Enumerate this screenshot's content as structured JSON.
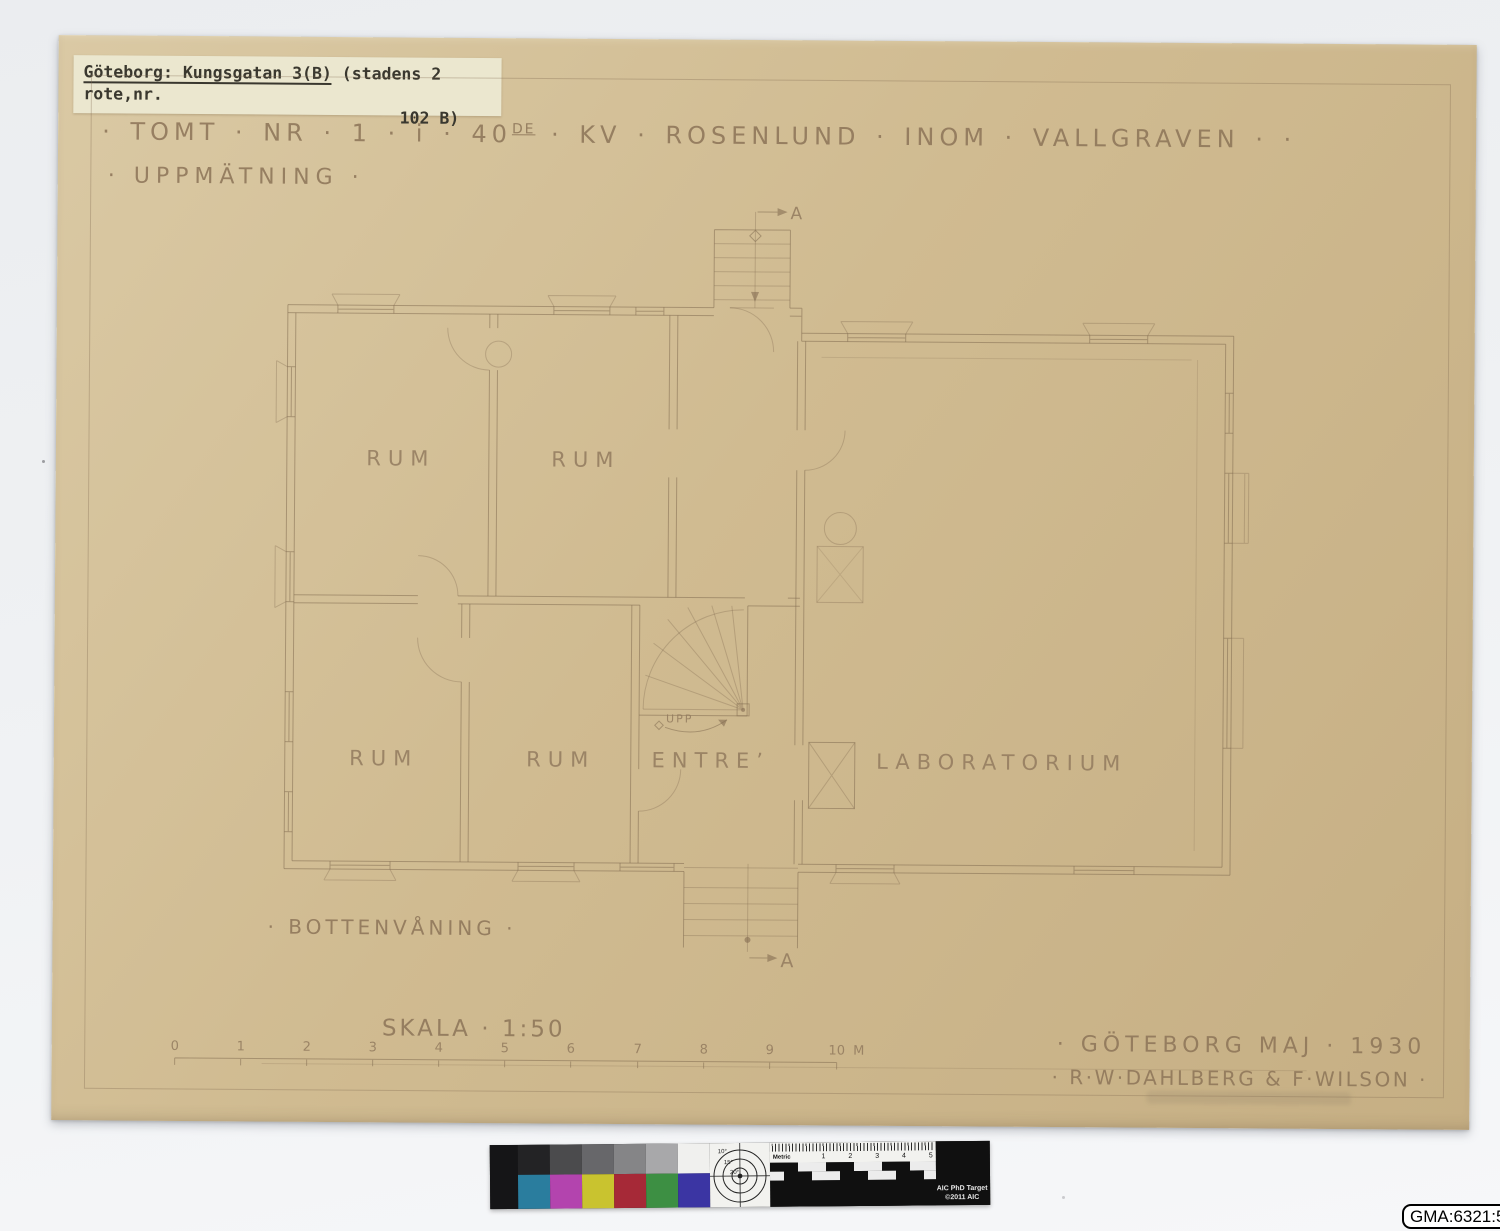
{
  "archive_label": {
    "underlined": "Göteborg: Kungsgatan 3(B)",
    "rest": " (stadens 2 rote,nr.",
    "line2": "102 B)"
  },
  "title": {
    "pre": "· TOMT · NR · 1 · i · 40",
    "sup": "DE",
    "post": " · KV · ROSENLUND · INOM · VALLGRAVEN · ·"
  },
  "subtitle": "· UPPMÄTNING ·",
  "plan": {
    "room_labels": {
      "rum1": "RUM",
      "rum2": "RUM",
      "rum3": "RUM",
      "rum4": "RUM",
      "entre": "ENTRE’",
      "laboratorium": "LABORATORIUM"
    },
    "stair_label": "UPP",
    "section_marker": "A",
    "floor_label": "· BOTTENVÅNING ·"
  },
  "scale": {
    "label": "SKALA · 1:50",
    "ticks": [
      "0",
      "1",
      "2",
      "3",
      "4",
      "5",
      "6",
      "7",
      "8",
      "9",
      "10"
    ],
    "unit": "M"
  },
  "signature": {
    "line1": "· GÖTEBORG  MAJ · 1930",
    "line2": "· R·W·DAHLBERG & F·WILSON ·"
  },
  "catalog_label": "GMA:6321:5",
  "color_target": {
    "gray_patches": [
      "#232325",
      "#4b4b4d",
      "#67676a",
      "#858587",
      "#a8a8aa",
      "#f0f0ee"
    ],
    "color_patches": [
      "#2a7d9e",
      "#b344ae",
      "#c9c32f",
      "#a62937",
      "#3d8f43",
      "#3b35a3"
    ],
    "degree_labels": [
      "10°",
      "15°",
      "20°"
    ],
    "ruler_label": "Metric",
    "ruler_numbers": [
      "1",
      "2",
      "3",
      "4",
      "5"
    ],
    "brand_line1": "AIC PhD Target",
    "brand_line2": "©2011 AIC"
  },
  "colors": {
    "paper": "#d0bb91",
    "pencil": "#8a7254",
    "backdrop": "#eff1f3",
    "label_paper": "#ebe7cf"
  }
}
